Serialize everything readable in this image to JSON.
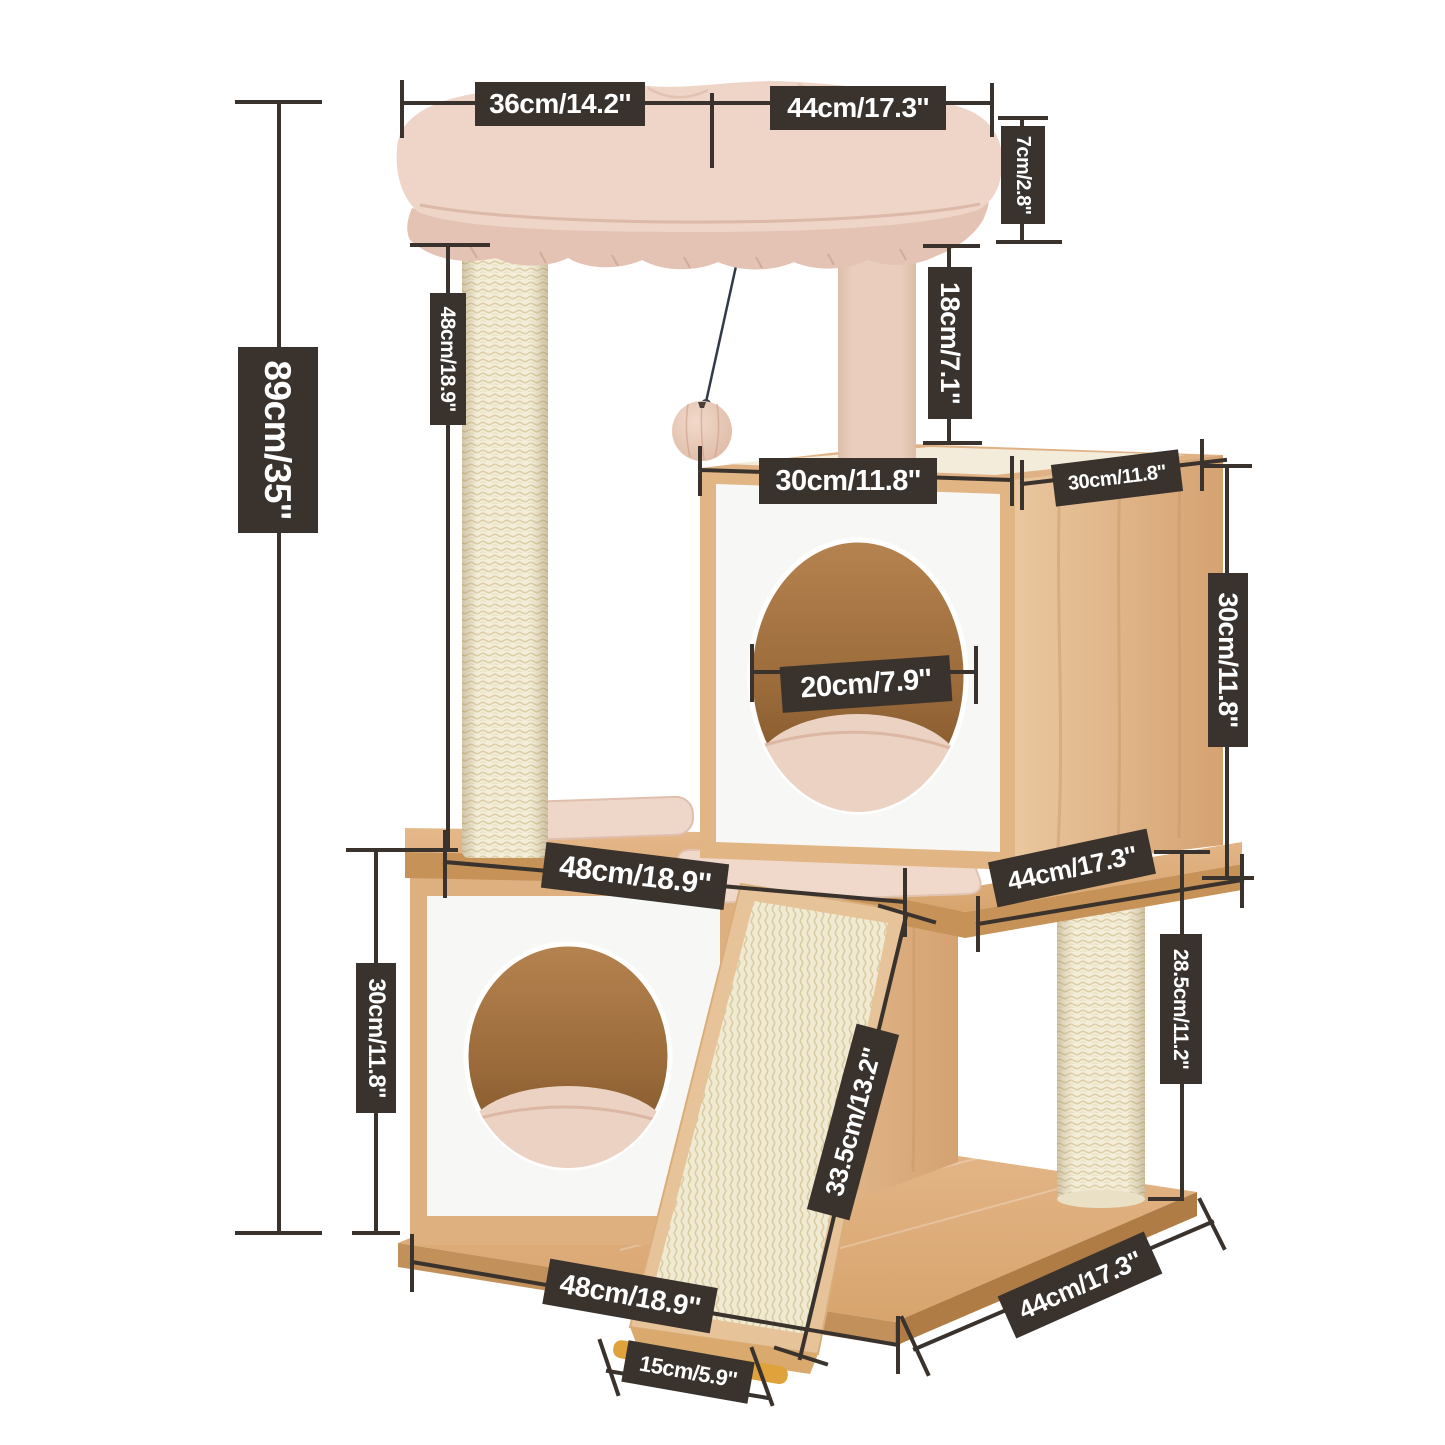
{
  "diagram": {
    "type": "product-dimension-diagram",
    "subject": "cat tree tower with two cube condos, top bed, scratching posts and ramp",
    "colors": {
      "badge_bg": "#3a332d",
      "badge_text": "#ffffff",
      "dimension_line": "#3a332d",
      "wood": "#e0b284",
      "wood_dark": "#c69257",
      "panel_white": "#f7f8f5",
      "plush_pink": "#ecd1c4",
      "sisal": "#f3edd9",
      "hole_interior": "#9a6a3a",
      "feet_gold": "#dfa33c",
      "background": "#ffffff"
    }
  },
  "labels": [
    {
      "id": "bed-top-left-width",
      "text": "36cm/14.2''"
    },
    {
      "id": "bed-top-right-width",
      "text": "44cm/17.3''"
    },
    {
      "id": "bed-cushion-height",
      "text": "7cm/2.8''"
    },
    {
      "id": "post-gap-height",
      "text": "18cm/7.1''"
    },
    {
      "id": "left-post-height",
      "text": "48cm/18.9''"
    },
    {
      "id": "total-height",
      "text": "89cm/35''"
    },
    {
      "id": "top-cube-front-width",
      "text": "30cm/11.8''"
    },
    {
      "id": "top-cube-depth",
      "text": "30cm/11.8''"
    },
    {
      "id": "entry-hole-diameter",
      "text": "20cm/7.9''"
    },
    {
      "id": "top-cube-height",
      "text": "30cm/11.8''"
    },
    {
      "id": "platform-width",
      "text": "48cm/18.9''"
    },
    {
      "id": "platform-depth",
      "text": "44cm/17.3''"
    },
    {
      "id": "lower-cube-height",
      "text": "30cm/11.8''"
    },
    {
      "id": "ramp-length",
      "text": "33.5cm/13.2''"
    },
    {
      "id": "lower-post-height",
      "text": "28.5cm/11.2''"
    },
    {
      "id": "base-width",
      "text": "48cm/18.9''"
    },
    {
      "id": "ramp-foot-width",
      "text": "15cm/5.9''"
    },
    {
      "id": "base-depth",
      "text": "44cm/17.3''"
    }
  ]
}
